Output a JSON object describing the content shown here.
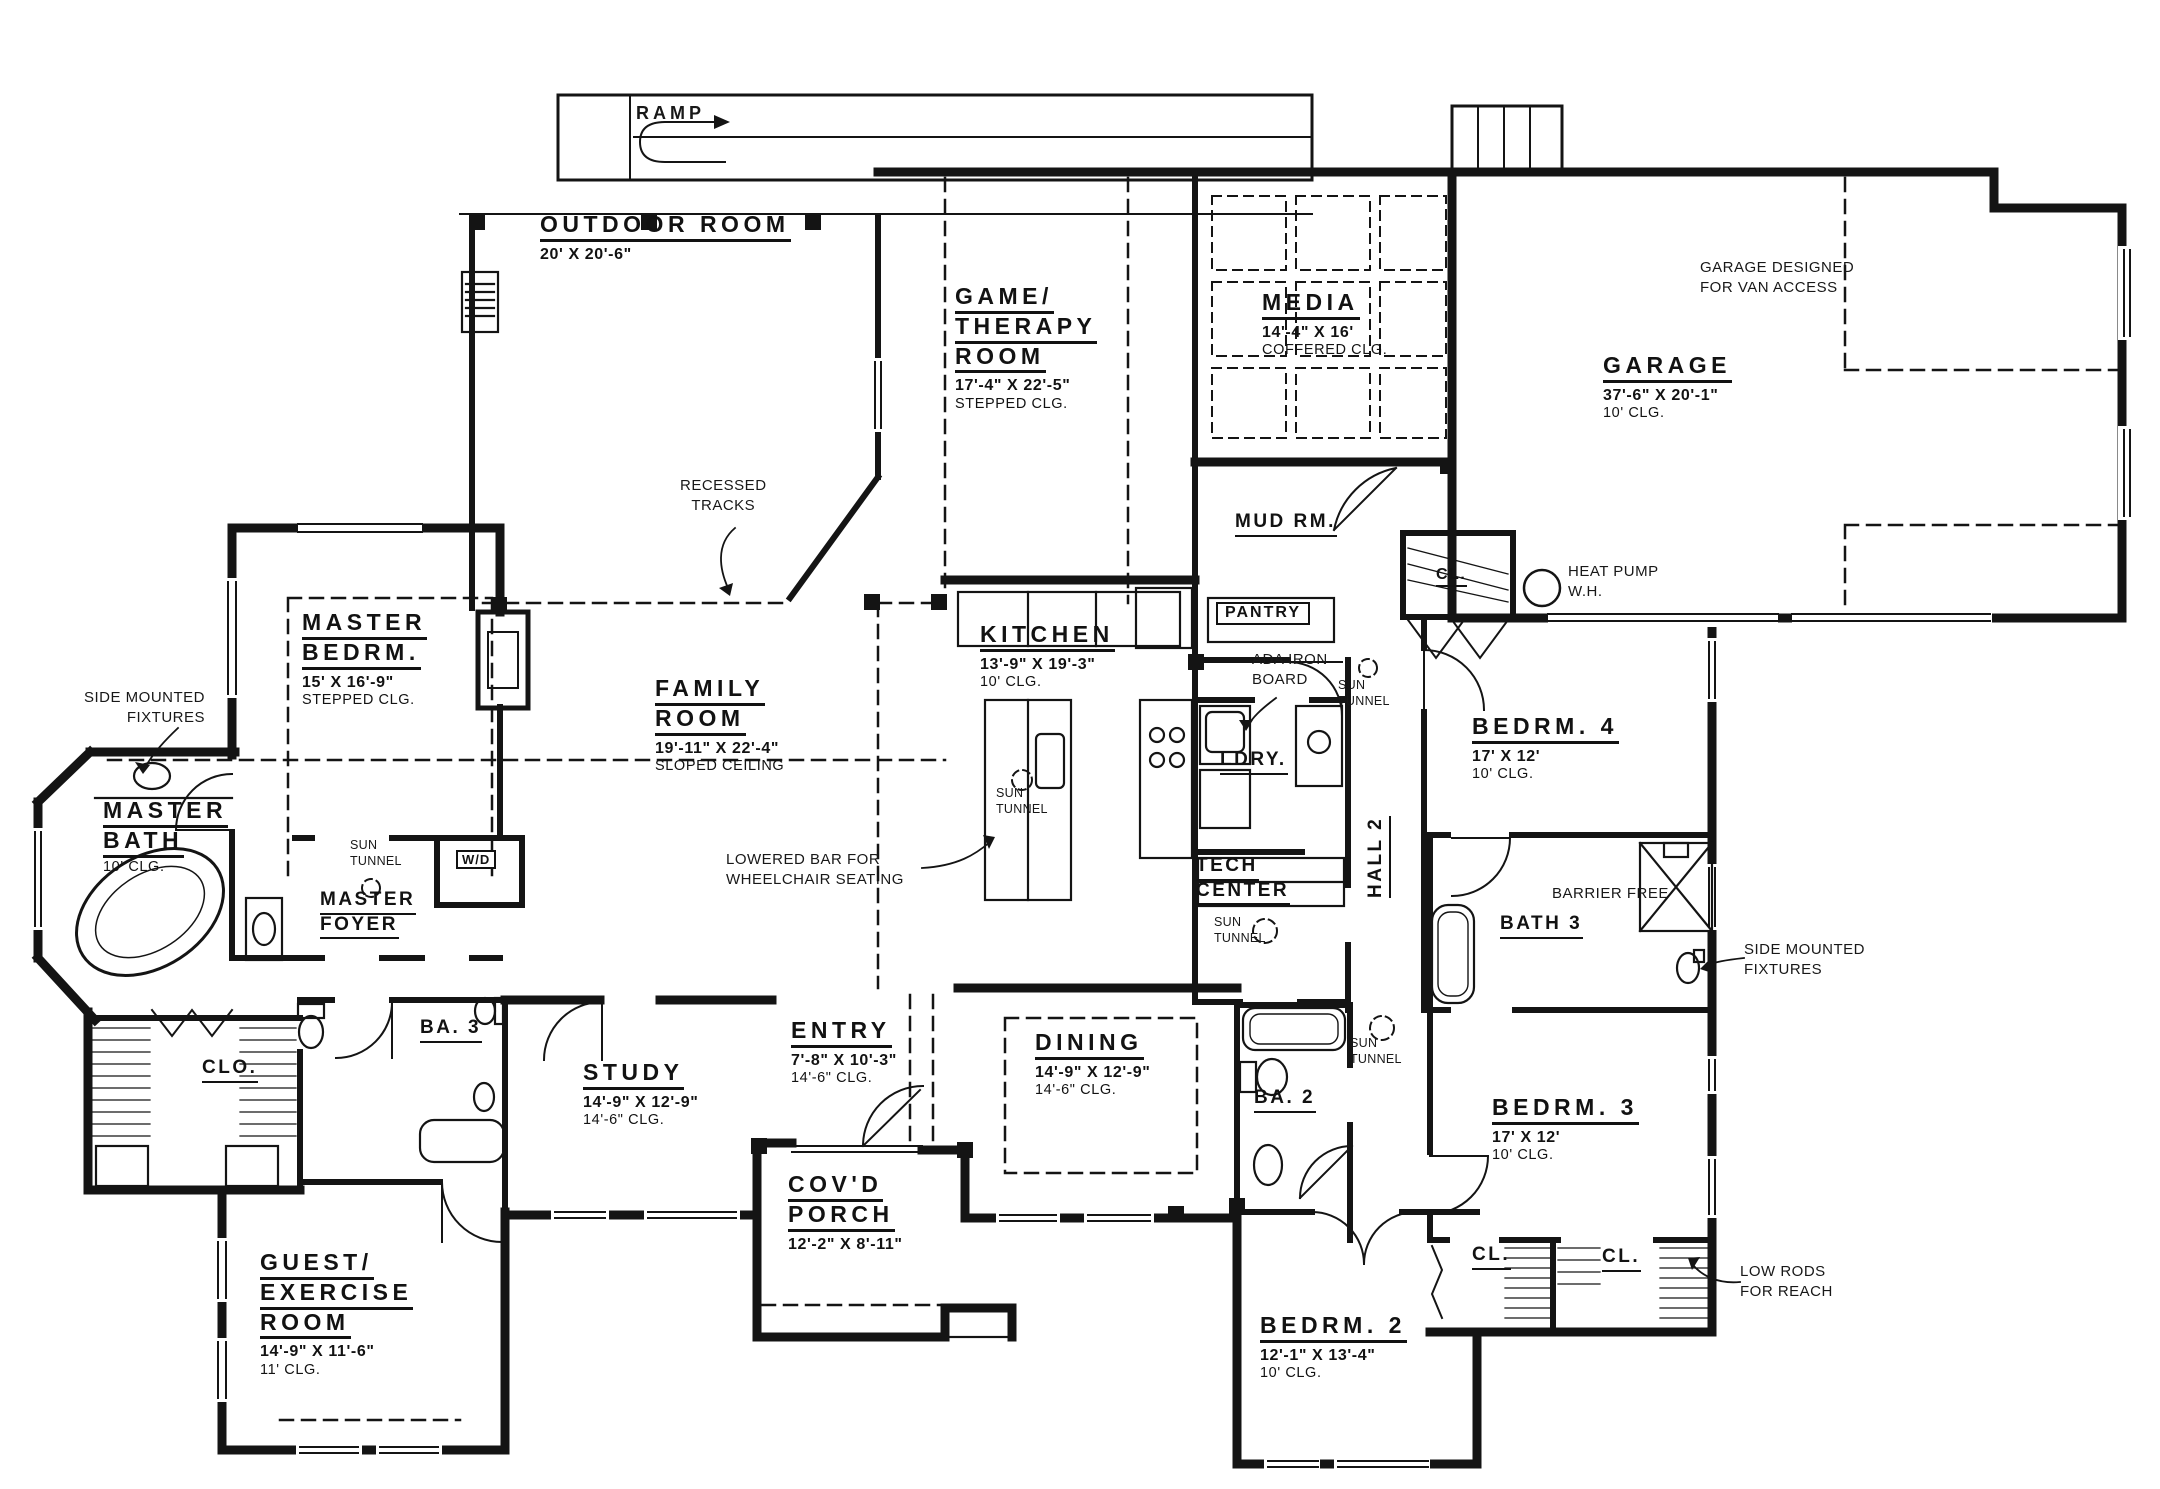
{
  "rooms": [
    {
      "id": "outdoor-room",
      "lines": [
        "OUTDOOR ROOM"
      ],
      "dims": "20' X 20'-6\""
    },
    {
      "id": "game-therapy-room",
      "lines": [
        "GAME/",
        "THERAPY",
        "ROOM"
      ],
      "dims": "17'-4\" X 22'-5\"",
      "ceiling": "STEPPED CLG."
    },
    {
      "id": "media",
      "lines": [
        "MEDIA"
      ],
      "dims": "14'-4\" X 16'",
      "ceiling": "COFFERED CLG."
    },
    {
      "id": "garage",
      "lines": [
        "GARAGE"
      ],
      "dims": "37'-6\" X 20'-1\"",
      "ceiling": "10' CLG."
    },
    {
      "id": "mud-rm",
      "lines": [
        "MUD RM."
      ]
    },
    {
      "id": "master-bedrm",
      "lines": [
        "MASTER",
        "BEDRM."
      ],
      "dims": "15' X 16'-9\"",
      "ceiling": "STEPPED CLG."
    },
    {
      "id": "family-room",
      "lines": [
        "FAMILY",
        "ROOM"
      ],
      "dims": "19'-11\" X 22'-4\"",
      "ceiling": "SLOPED CEILING"
    },
    {
      "id": "kitchen",
      "lines": [
        "KITCHEN"
      ],
      "dims": "13'-9\" X 19'-3\"",
      "ceiling": "10' CLG."
    },
    {
      "id": "bedrm-4",
      "lines": [
        "BEDRM. 4"
      ],
      "dims": "17' X 12'",
      "ceiling": "10' CLG."
    },
    {
      "id": "master-bath",
      "lines": [
        "MASTER",
        "BATH"
      ],
      "ceiling": "10' CLG."
    },
    {
      "id": "master-foyer",
      "lines": [
        "MASTER",
        "FOYER"
      ]
    },
    {
      "id": "ldry",
      "lines": [
        "LDRY."
      ]
    },
    {
      "id": "hall-2",
      "lines": [
        "HALL 2"
      ]
    },
    {
      "id": "tech-center",
      "lines": [
        "TECH",
        "CENTER"
      ]
    },
    {
      "id": "bath-3",
      "lines": [
        "BATH 3"
      ]
    },
    {
      "id": "study",
      "lines": [
        "STUDY"
      ],
      "dims": "14'-9\" X 12'-9\"",
      "ceiling": "14'-6\" CLG."
    },
    {
      "id": "entry",
      "lines": [
        "ENTRY"
      ],
      "dims": "7'-8\" X 10'-3\"",
      "ceiling": "14'-6\" CLG."
    },
    {
      "id": "dining",
      "lines": [
        "DINING"
      ],
      "dims": "14'-9\" X 12'-9\"",
      "ceiling": "14'-6\" CLG."
    },
    {
      "id": "ba-2",
      "lines": [
        "BA. 2"
      ]
    },
    {
      "id": "ba-3",
      "lines": [
        "BA. 3"
      ]
    },
    {
      "id": "covd-porch",
      "lines": [
        "COV'D",
        "PORCH"
      ],
      "dims": "12'-2\" X 8'-11\""
    },
    {
      "id": "bedrm-3",
      "lines": [
        "BEDRM. 3"
      ],
      "dims": "17' X 12'",
      "ceiling": "10' CLG."
    },
    {
      "id": "bedrm-2",
      "lines": [
        "BEDRM. 2"
      ],
      "dims": "12'-1\" X 13'-4\"",
      "ceiling": "10' CLG."
    },
    {
      "id": "clo",
      "lines": [
        "CLO."
      ]
    },
    {
      "id": "guest-exercise-room",
      "lines": [
        "GUEST/",
        "EXERCISE",
        "ROOM"
      ],
      "dims": "14'-9\" X 11'-6\"",
      "ceiling": "11' CLG."
    },
    {
      "id": "cl-water-heater",
      "lines": [
        "CL."
      ]
    },
    {
      "id": "cl-bedrm3-left",
      "lines": [
        "CL."
      ]
    },
    {
      "id": "cl-bedrm3-right",
      "lines": [
        "CL."
      ]
    }
  ],
  "notes": {
    "ramp": "RAMP",
    "recessed_tracks": [
      "RECESSED",
      "TRACKS"
    ],
    "garage_van": [
      "GARAGE DESIGNED",
      "FOR VAN ACCESS"
    ],
    "heat_pump": [
      "HEAT PUMP",
      "W.H."
    ],
    "ada_iron_board": [
      "ADA IRON",
      "BOARD"
    ],
    "sun_tunnel": [
      "SUN",
      "TUNNEL"
    ],
    "side_mounted": [
      "SIDE MOUNTED",
      "FIXTURES"
    ],
    "lowered_bar": [
      "LOWERED BAR FOR",
      "WHEELCHAIR SEATING"
    ],
    "barrier_free": "BARRIER FREE",
    "low_rods": [
      "LOW RODS",
      "FOR REACH"
    ],
    "pantry": "PANTRY",
    "washer_dryer": "W/D"
  },
  "colors": {
    "ink": "#141414",
    "paper": "#ffffff"
  }
}
